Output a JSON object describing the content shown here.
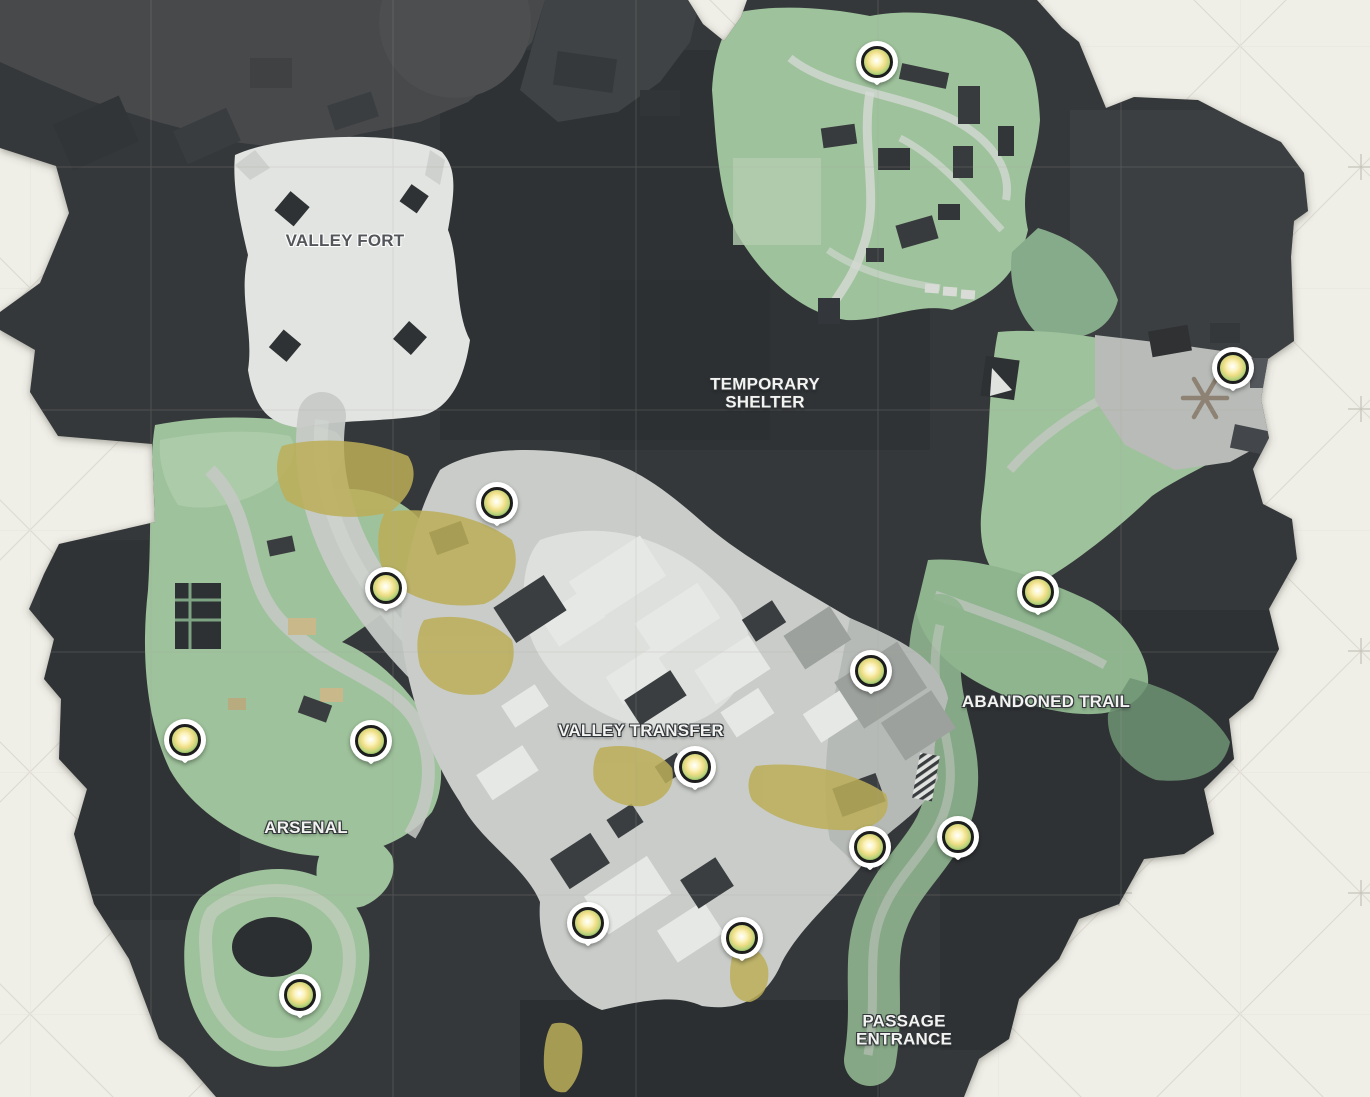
{
  "map": {
    "name": "valley-area-map",
    "palette": {
      "background": "#efeee7",
      "background_pattern_line": "#dcdad1",
      "background_cross": "#c6c4ba",
      "terrain_dark": "#34383a",
      "terrain_darker": "#272a2c",
      "building_gray": "#47494b",
      "snow_white": "#e2e4e1",
      "road_gray": "#c7cac6",
      "grass_green": "#9ec29b",
      "grass_green_dark": "#729676",
      "sand_yellow": "#bcae58",
      "marker_ring": "#1c1d1c",
      "marker_glow_yellow": "#eedd85",
      "marker_glow_green": "#74a758"
    },
    "labels": [
      {
        "id": "valley-fort",
        "lines": [
          "VALLEY FORT"
        ],
        "x": 345,
        "y": 241,
        "style": "dark"
      },
      {
        "id": "temporary-shelter",
        "lines": [
          "TEMPORARY",
          "SHELTER"
        ],
        "x": 765,
        "y": 394,
        "style": "light"
      },
      {
        "id": "valley-transfer",
        "lines": [
          "VALLEY TRANSFER"
        ],
        "x": 641,
        "y": 731,
        "style": "light"
      },
      {
        "id": "abandoned-trail",
        "lines": [
          "ABANDONED TRAIL"
        ],
        "x": 1046,
        "y": 702,
        "style": "light"
      },
      {
        "id": "arsenal",
        "lines": [
          "ARSENAL"
        ],
        "x": 306,
        "y": 828,
        "style": "light"
      },
      {
        "id": "passage-entrance",
        "lines": [
          "PASSAGE",
          "ENTRANCE"
        ],
        "x": 904,
        "y": 1031,
        "style": "light"
      }
    ],
    "marker_type": "loot-orb-collectible",
    "marker_count": 14,
    "markers": [
      {
        "x": 877,
        "y": 62
      },
      {
        "x": 1233,
        "y": 368
      },
      {
        "x": 1038,
        "y": 592
      },
      {
        "x": 871,
        "y": 671
      },
      {
        "x": 497,
        "y": 503
      },
      {
        "x": 386,
        "y": 588
      },
      {
        "x": 185,
        "y": 740
      },
      {
        "x": 371,
        "y": 741
      },
      {
        "x": 695,
        "y": 767
      },
      {
        "x": 870,
        "y": 847
      },
      {
        "x": 958,
        "y": 837
      },
      {
        "x": 588,
        "y": 923
      },
      {
        "x": 742,
        "y": 938
      },
      {
        "x": 300,
        "y": 995
      }
    ]
  }
}
